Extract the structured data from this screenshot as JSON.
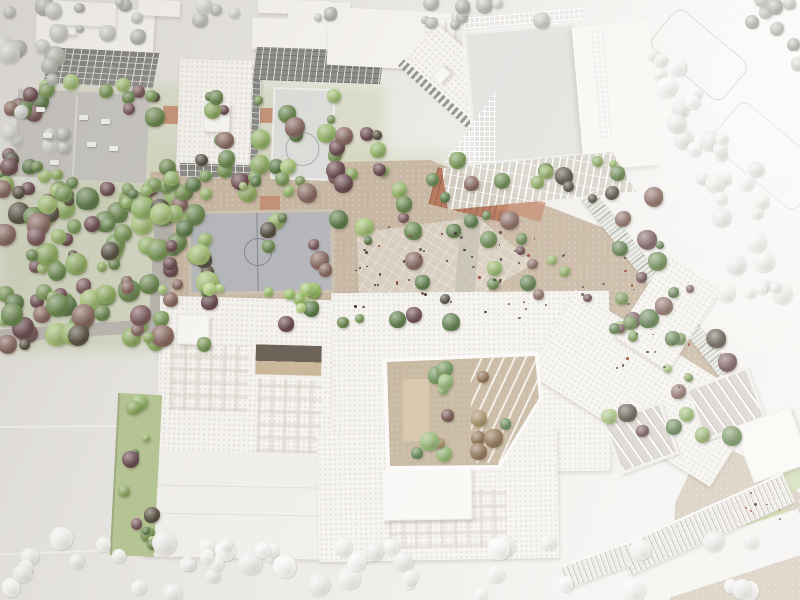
{
  "meta": {
    "scene_kind": "aerial-photo-of-architectural-scale-model",
    "description": "Top-down photograph of a white cardboard urban design model: school campus block with courtyards, sports fields, dense painted tree clusters (greens and purples) inside the site and unpainted white trees along the surrounding streets."
  },
  "palette": {
    "board": "#e9e7e3",
    "board_light": "#f6f5f3",
    "building": "#f6f4f0",
    "building_dim": "#f1efea",
    "facade_dark": "#8f8e8a",
    "parking": "#c8c6c2",
    "path": "#b4b1ac",
    "garden": "#c8b7a2",
    "plaza": "#d8cebf",
    "courtyard": "#c6b69e",
    "court_blue": "#b6b8bc",
    "court_border": "#cfc3b1",
    "court_light": "#dedfdc",
    "terracotta": "#b5795d",
    "terracotta_light": "#c4886b",
    "lawn": "#ccd8a8",
    "green_ground": "#c5cda4",
    "green_strip": "#b7c595",
    "car": "#f2f2f0"
  },
  "tree_palettes": {
    "mixed": [
      "#7b9a58",
      "#8fae62",
      "#6b8a50",
      "#a5c276",
      "#5d7d4a",
      "#97b86b",
      "#6d4c52",
      "#7d5a5e",
      "#8a6a62",
      "#585043"
    ],
    "greens": [
      "#7b9a58",
      "#8fae62",
      "#6b8a50",
      "#a5c276",
      "#5d7d4a",
      "#97b86b"
    ],
    "light_row": [
      "#a6c873",
      "#b4d37f",
      "#93bd62",
      "#9fc46e",
      "#5d7d4a"
    ],
    "courtyard": [
      "#6f9459",
      "#8fb46d",
      "#744e48",
      "#8a6a4a",
      "#a58a5f",
      "#5f8450"
    ],
    "white": [
      "#f2f1ee",
      "#eae9e6",
      "#f6f5f3",
      "#efeeea"
    ],
    "gray": [
      "#c6c7c1",
      "#b9bab3",
      "#d2d2cd",
      "#aeb0a8"
    ],
    "dots": [
      "#6b5f54",
      "#9a4632",
      "#54483e",
      "#3f3a34"
    ]
  },
  "vegetation": [
    {
      "n": "forest-main",
      "x": 0,
      "y": 185,
      "w": 210,
      "h": 160,
      "c": 115,
      "r1": 5,
      "r2": 12,
      "p": "mixed"
    },
    {
      "n": "forest-top-row",
      "x": 12,
      "y": 80,
      "w": 145,
      "h": 38,
      "c": 16,
      "r1": 5,
      "r2": 10,
      "p": "mixed"
    },
    {
      "n": "parking-south-row",
      "x": 0,
      "y": 165,
      "w": 168,
      "h": 34,
      "c": 16,
      "r1": 5,
      "r2": 9,
      "p": "greens"
    },
    {
      "n": "left-edge",
      "x": 0,
      "y": 95,
      "w": 26,
      "h": 95,
      "c": 8,
      "r1": 5,
      "r2": 9,
      "p": "mixed"
    },
    {
      "n": "courts-area",
      "x": 195,
      "y": 92,
      "w": 150,
      "h": 108,
      "c": 24,
      "r1": 4,
      "r2": 10,
      "p": "mixed"
    },
    {
      "n": "bar-south",
      "x": 322,
      "y": 132,
      "w": 75,
      "h": 48,
      "c": 10,
      "r1": 5,
      "r2": 10,
      "p": "mixed"
    },
    {
      "n": "plaza-west",
      "x": 265,
      "y": 160,
      "w": 210,
      "h": 167,
      "c": 30,
      "r1": 4,
      "r2": 10,
      "p": "mixed"
    },
    {
      "n": "plaza-east",
      "x": 470,
      "y": 180,
      "w": 195,
      "h": 150,
      "c": 30,
      "r1": 4,
      "r2": 10,
      "p": "mixed"
    },
    {
      "n": "gym-south",
      "x": 540,
      "y": 160,
      "w": 80,
      "h": 45,
      "c": 8,
      "r1": 4,
      "r2": 9,
      "p": "mixed"
    },
    {
      "n": "corridor-garden",
      "x": 598,
      "y": 272,
      "w": 145,
      "h": 165,
      "c": 22,
      "r1": 4,
      "r2": 10,
      "p": "mixed"
    },
    {
      "n": "street-row",
      "x": 160,
      "y": 284,
      "w": 170,
      "h": 26,
      "c": 14,
      "r1": 4,
      "r2": 8,
      "p": "light_row"
    },
    {
      "n": "garden-top-row",
      "x": 162,
      "y": 172,
      "w": 125,
      "h": 24,
      "c": 11,
      "r1": 4,
      "r2": 8,
      "p": "greens"
    },
    {
      "n": "courtyard-trees",
      "x": 392,
      "y": 364,
      "w": 142,
      "h": 96,
      "c": 15,
      "r1": 5,
      "r2": 10,
      "p": "courtyard"
    },
    {
      "n": "west-strip-trees",
      "x": 116,
      "y": 398,
      "w": 38,
      "h": 155,
      "c": 12,
      "r1": 4,
      "r2": 9,
      "p": "mixed"
    },
    {
      "n": "white-diag-1",
      "x": 648,
      "y": 52,
      "w": 42,
      "h": 48,
      "c": 6,
      "r1": 5,
      "r2": 10,
      "p": "white"
    },
    {
      "n": "white-diag-2",
      "x": 670,
      "y": 92,
      "w": 44,
      "h": 50,
      "c": 6,
      "r1": 5,
      "r2": 10,
      "p": "white"
    },
    {
      "n": "white-diag-3",
      "x": 692,
      "y": 132,
      "w": 46,
      "h": 50,
      "c": 6,
      "r1": 5,
      "r2": 10,
      "p": "white"
    },
    {
      "n": "white-diag-4",
      "x": 712,
      "y": 168,
      "w": 50,
      "h": 52,
      "c": 7,
      "r1": 5,
      "r2": 10,
      "p": "white"
    },
    {
      "n": "white-right",
      "x": 724,
      "y": 195,
      "w": 72,
      "h": 100,
      "c": 9,
      "r1": 5,
      "r2": 11,
      "p": "white"
    },
    {
      "n": "gray-nw",
      "x": 0,
      "y": 0,
      "w": 72,
      "h": 150,
      "c": 18,
      "r1": 5,
      "r2": 11,
      "p": "gray"
    },
    {
      "n": "gray-n",
      "x": 78,
      "y": 0,
      "w": 62,
      "h": 42,
      "c": 7,
      "r1": 4,
      "r2": 9,
      "p": "gray"
    },
    {
      "n": "gray-top-center",
      "x": 424,
      "y": 0,
      "w": 122,
      "h": 32,
      "c": 11,
      "r1": 4,
      "r2": 9,
      "p": "gray"
    },
    {
      "n": "gray-ne",
      "x": 742,
      "y": 0,
      "w": 58,
      "h": 82,
      "c": 9,
      "r1": 5,
      "r2": 10,
      "p": "gray"
    },
    {
      "n": "gray-gap-1",
      "x": 196,
      "y": 0,
      "w": 42,
      "h": 24,
      "c": 4,
      "r1": 4,
      "r2": 8,
      "p": "gray"
    },
    {
      "n": "gray-gap-2",
      "x": 298,
      "y": 0,
      "w": 34,
      "h": 20,
      "c": 3,
      "r1": 4,
      "r2": 7,
      "p": "gray"
    },
    {
      "n": "white-bottom-row",
      "x": 0,
      "y": 538,
      "w": 790,
      "h": 58,
      "c": 46,
      "r1": 6,
      "r2": 12,
      "p": "white"
    },
    {
      "n": "people-plaza",
      "x": 352,
      "y": 226,
      "w": 190,
      "h": 86,
      "c": 40,
      "r1": 0.8,
      "r2": 1.6,
      "p": "dots"
    },
    {
      "n": "people-garden",
      "x": 500,
      "y": 250,
      "w": 140,
      "h": 70,
      "c": 18,
      "r1": 0.8,
      "r2": 1.5,
      "p": "dots"
    },
    {
      "n": "people-corridor",
      "x": 610,
      "y": 310,
      "w": 80,
      "h": 80,
      "c": 10,
      "r1": 0.8,
      "r2": 1.5,
      "p": "dots"
    },
    {
      "n": "people-se",
      "x": 740,
      "y": 490,
      "w": 50,
      "h": 30,
      "c": 8,
      "r1": 0.8,
      "r2": 1.4,
      "p": "dots"
    }
  ],
  "cars": [
    {
      "x": 36,
      "y": 107
    },
    {
      "x": 79,
      "y": 115
    },
    {
      "x": 101,
      "y": 119
    },
    {
      "x": 43,
      "y": 133
    },
    {
      "x": 87,
      "y": 142
    },
    {
      "x": 50,
      "y": 160
    },
    {
      "x": 109,
      "y": 146
    }
  ]
}
